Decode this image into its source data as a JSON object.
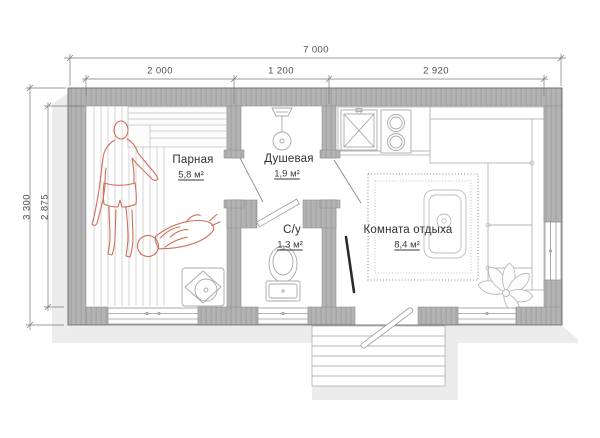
{
  "drawing": {
    "type": "floor-plan",
    "language": "ru"
  },
  "dimensions": {
    "total_width": "7 000",
    "segments": [
      "2 000",
      "1 200",
      "2 920"
    ],
    "total_depth": "3 300",
    "interior_depth": "2 875"
  },
  "rooms": {
    "parnaya": {
      "name": "Парная",
      "area": "5,8 м²"
    },
    "dushevaya": {
      "name": "Душевая",
      "area": "1,9 м²"
    },
    "su": {
      "name": "С/у",
      "area": "1,3 м²"
    },
    "komnata": {
      "name": "Комната отдыха",
      "area": "8,4 м²"
    }
  },
  "fixtures": [
    "sauna-bench",
    "sauna-heater",
    "shower-head",
    "toilet",
    "kitchen-sink",
    "cooktop",
    "corner-sofa",
    "coffee-table",
    "rug",
    "plant",
    "entrance-stairs",
    "entrance-door",
    "window-sauna",
    "window-wc",
    "window-lounge",
    "window-right"
  ],
  "figures": [
    "standing-person",
    "lying-person"
  ],
  "colors": {
    "wall": "#b3b3b3",
    "wall_hatch": "#a1a1a1",
    "outline": "#6e6e6e",
    "furniture_line": "#b5b5b5",
    "figure_red": "#cf6f5b",
    "dimension_line": "#777777",
    "text": "#3a3a3a",
    "shadow": "#ececec",
    "floor": "#ffffff"
  }
}
